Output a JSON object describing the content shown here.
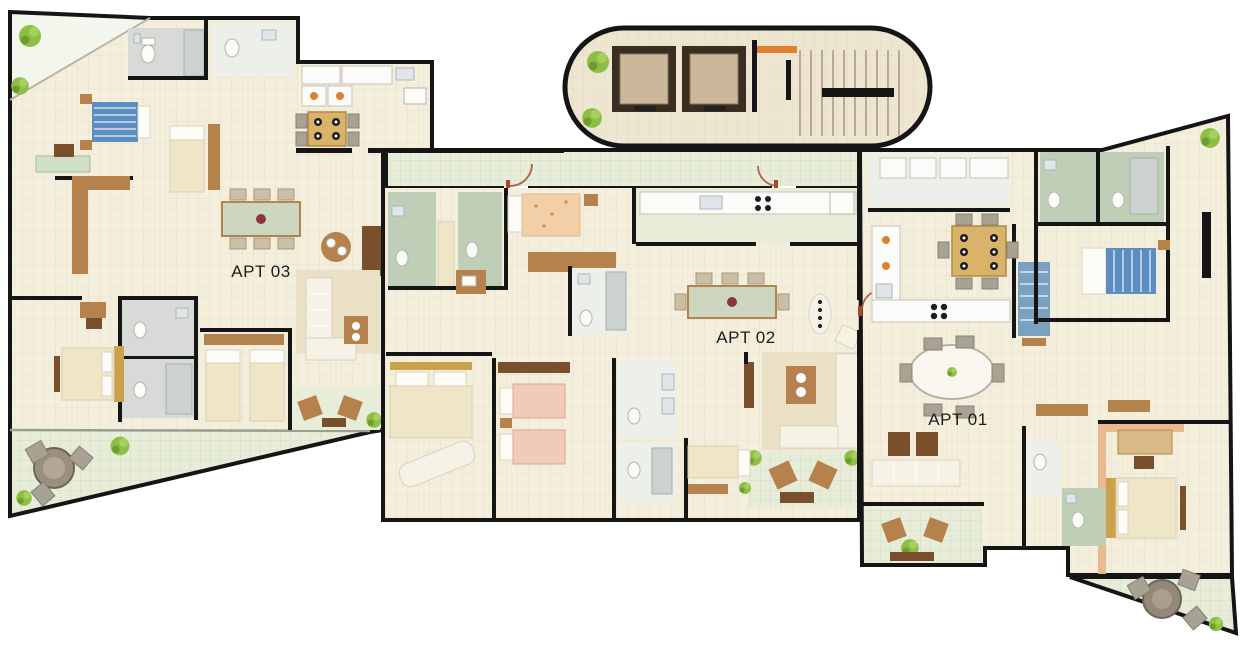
{
  "figure": {
    "type": "residential-floor-plan",
    "apartments": [
      {
        "id": "apt-01",
        "label": "APT 01"
      },
      {
        "id": "apt-02",
        "label": "APT 02"
      },
      {
        "id": "apt-03",
        "label": "APT 03"
      }
    ]
  },
  "colors": {
    "background": "#ffffff",
    "wall": "#151515",
    "floor_beige": "#f4eedd",
    "floor_tan": "#efe6d2",
    "tile_green": "#e8edda",
    "bath_gray": "#d8dad8",
    "bath_green": "#bfceb6",
    "tile_white": "#edefeb",
    "wood": "#b5824e",
    "wood_dark": "#7a4f2c",
    "bed_blue": "#5d8ec2",
    "bed_peach": "#f2cfa6",
    "bed_cream": "#efe6c8",
    "gold": "#c9a24b",
    "sofa_cream": "#f6f2e6",
    "counter_white": "#fbfbf9",
    "plant_green": "#8cbf44",
    "rug": "#e9e0c6",
    "accent_orange": "#e0802f",
    "door": "#a34b28",
    "label_text": "#1c1c1c"
  }
}
